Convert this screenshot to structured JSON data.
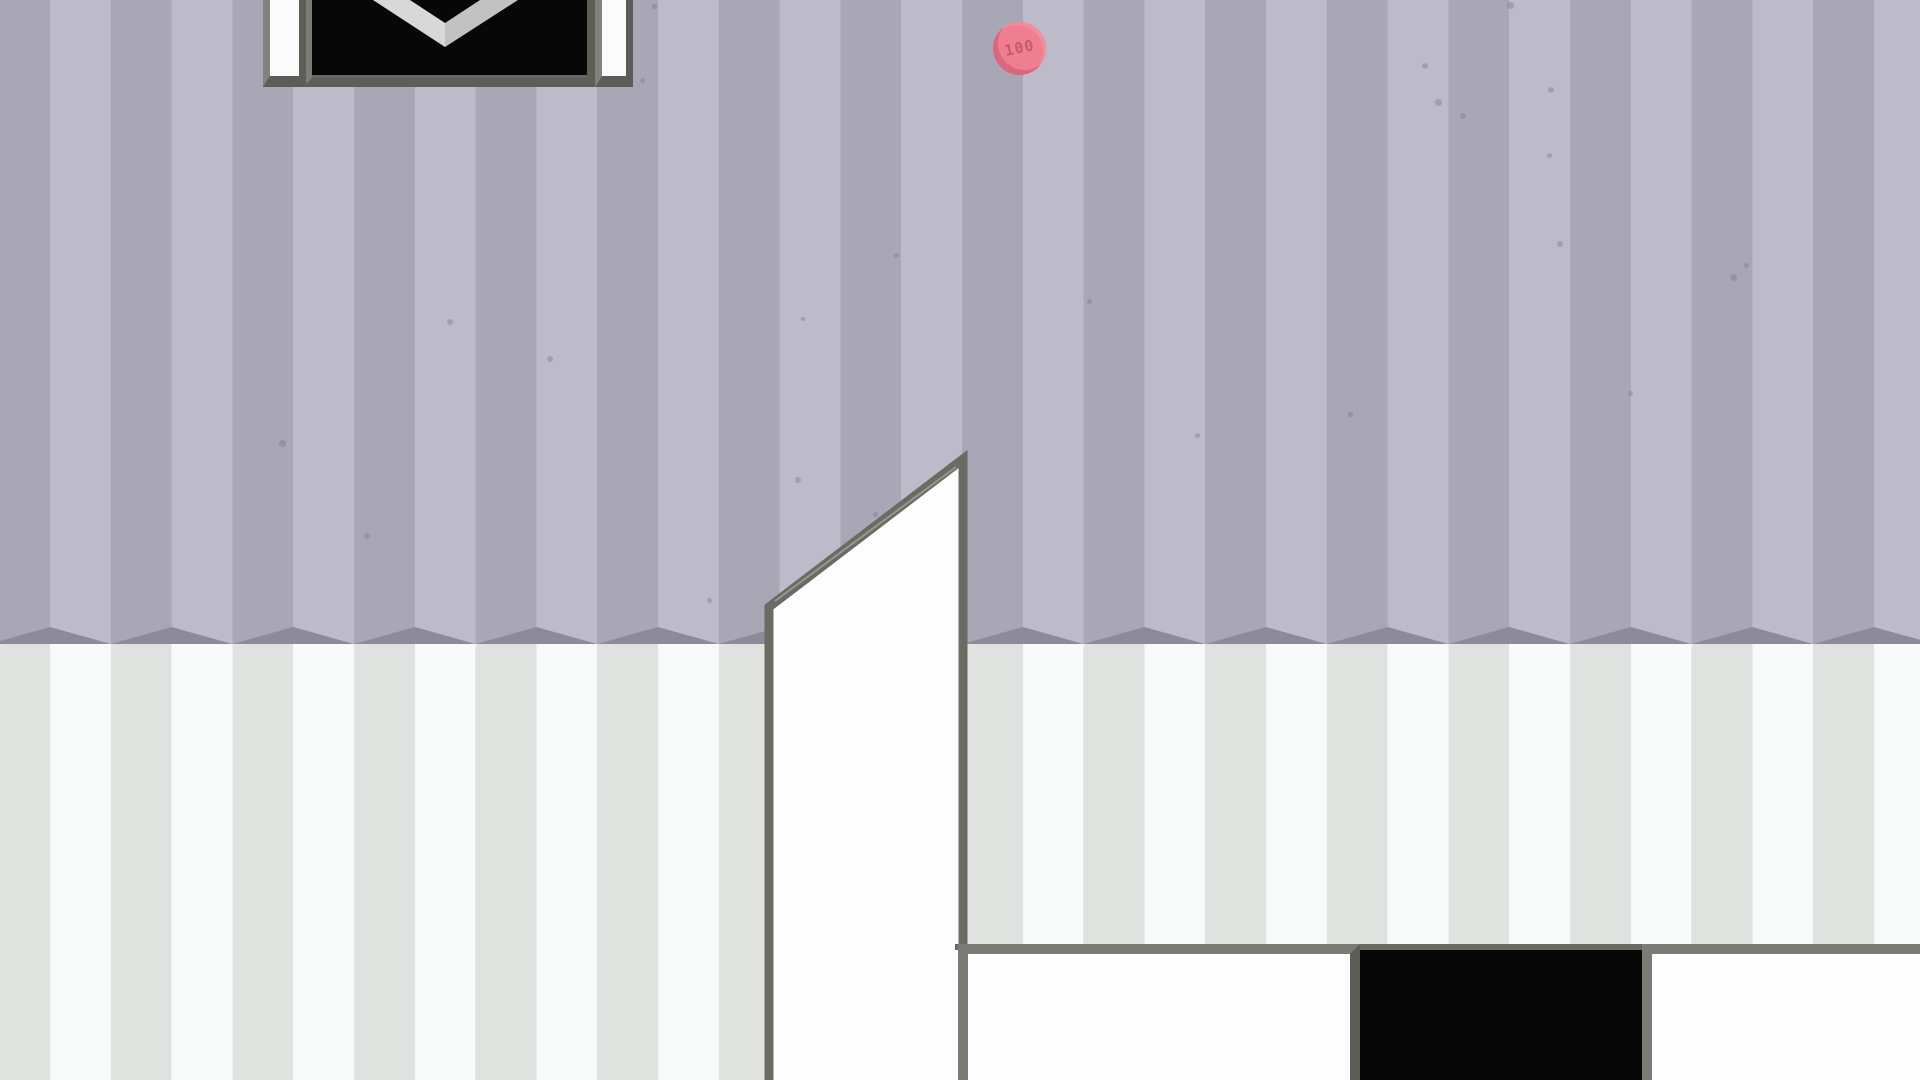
{
  "coin": {
    "value": "100"
  },
  "colors": {
    "wall_upper_stripe_dark": "#a9a6b5",
    "wall_upper_stripe_light": "#bdbac9",
    "wall_fold_shadow": "#8d8a9a",
    "wall_lower_stripe_dark": "#dfe2df",
    "wall_lower_stripe_light": "#f7faf8",
    "structure_fill": "#fdfdfd",
    "structure_border": "#6b6b64",
    "opening_black": "#070707",
    "coin_pink": "#ee7e90",
    "coin_text": "#c25a70",
    "chevron_left_face": "#d8d8d8",
    "chevron_right_face": "#c2c2c2"
  },
  "background": {
    "specks": [
      [
        447,
        319,
        6
      ],
      [
        547,
        356,
        6
      ],
      [
        279,
        440,
        7
      ],
      [
        364,
        533,
        6
      ],
      [
        707,
        598,
        5
      ],
      [
        795,
        477,
        6
      ],
      [
        873,
        512,
        5
      ],
      [
        894,
        253,
        5
      ],
      [
        1087,
        299,
        5
      ],
      [
        1195,
        433,
        5
      ],
      [
        1348,
        412,
        5
      ],
      [
        1422,
        63,
        6
      ],
      [
        1435,
        99,
        7
      ],
      [
        1460,
        113,
        6
      ],
      [
        1507,
        2,
        7
      ],
      [
        1548,
        87,
        6
      ],
      [
        1547,
        153,
        5
      ],
      [
        1557,
        241,
        6
      ],
      [
        1730,
        274,
        7
      ],
      [
        1628,
        391,
        5
      ],
      [
        1744,
        263,
        5
      ],
      [
        640,
        78,
        5
      ],
      [
        652,
        4,
        5
      ],
      [
        801,
        317,
        4
      ]
    ]
  }
}
